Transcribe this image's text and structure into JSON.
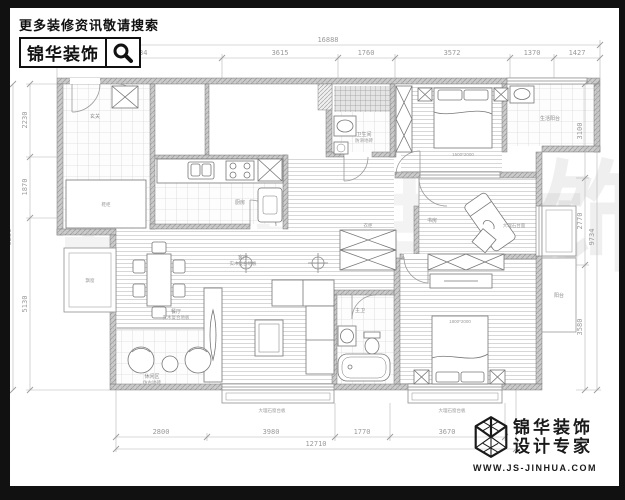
{
  "header": {
    "slogan": "更多装修资讯敬请搜索",
    "brand": "锦华装饰"
  },
  "footer": {
    "brand_line1": "锦华装饰",
    "brand_line2": "设计专家",
    "site": "WWW.JS-JINHUA.COM"
  },
  "watermark": {
    "c1": "锦",
    "c2": "华",
    "c3": "装",
    "c4": "饰"
  },
  "dimensions": {
    "top_total": "16888",
    "top_segments": [
      "5134",
      "3615",
      "1760",
      "3572",
      "1370",
      "1427"
    ],
    "left_segments": [
      "2230",
      "1870",
      "5130"
    ],
    "left_total": "9230",
    "right_segments": [
      "3100",
      "2770",
      "3580"
    ],
    "right_total": "9734",
    "bottom_segments": [
      "2800",
      "3980",
      "1770",
      "3670"
    ],
    "bottom_total": "12710"
  },
  "labels": {
    "entry": "玄关",
    "shoe": "鞋柜",
    "kitchen": "厨房",
    "dining": "餐厅",
    "dining_note": "实木复合地板",
    "living": "客厅",
    "living_note": "实木复合地板",
    "leisure": "休闲区",
    "leisure_note": "仿古地砖",
    "hall_closet": "衣柜",
    "bath1": "卫生间",
    "bath1_note": "防滑地砖",
    "bed1_size": "1500*2000",
    "laundry": "生活阳台",
    "study": "书房",
    "bay_note": "大理石台面",
    "master_size": "1800*2000",
    "bath2": "主卫",
    "balcony": "阳台",
    "bay_left": "飘窗",
    "sill_note": "大理石窗台板"
  }
}
